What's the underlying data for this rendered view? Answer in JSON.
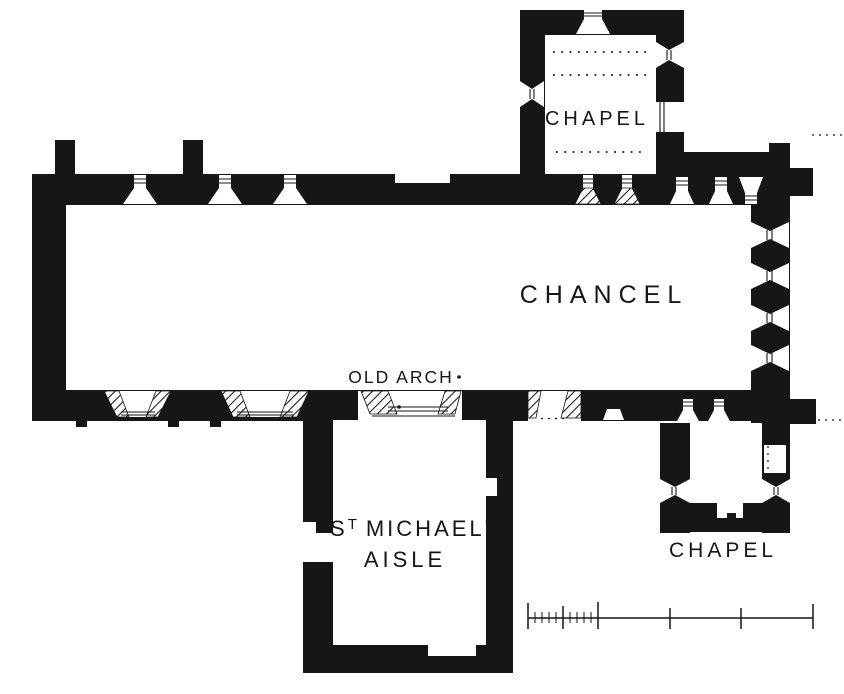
{
  "colors": {
    "ink": "#161616",
    "paper": "#ffffff"
  },
  "labels": {
    "north_chapel": "CHAPEL",
    "chancel": "CHANCEL",
    "old_arch": "OLD ARCH",
    "aisle_prefix": "S",
    "aisle_sup": "T",
    "aisle_rest": "MICHAEL'S",
    "aisle_line2": "AISLE",
    "south_chapel": "CHAPEL"
  }
}
